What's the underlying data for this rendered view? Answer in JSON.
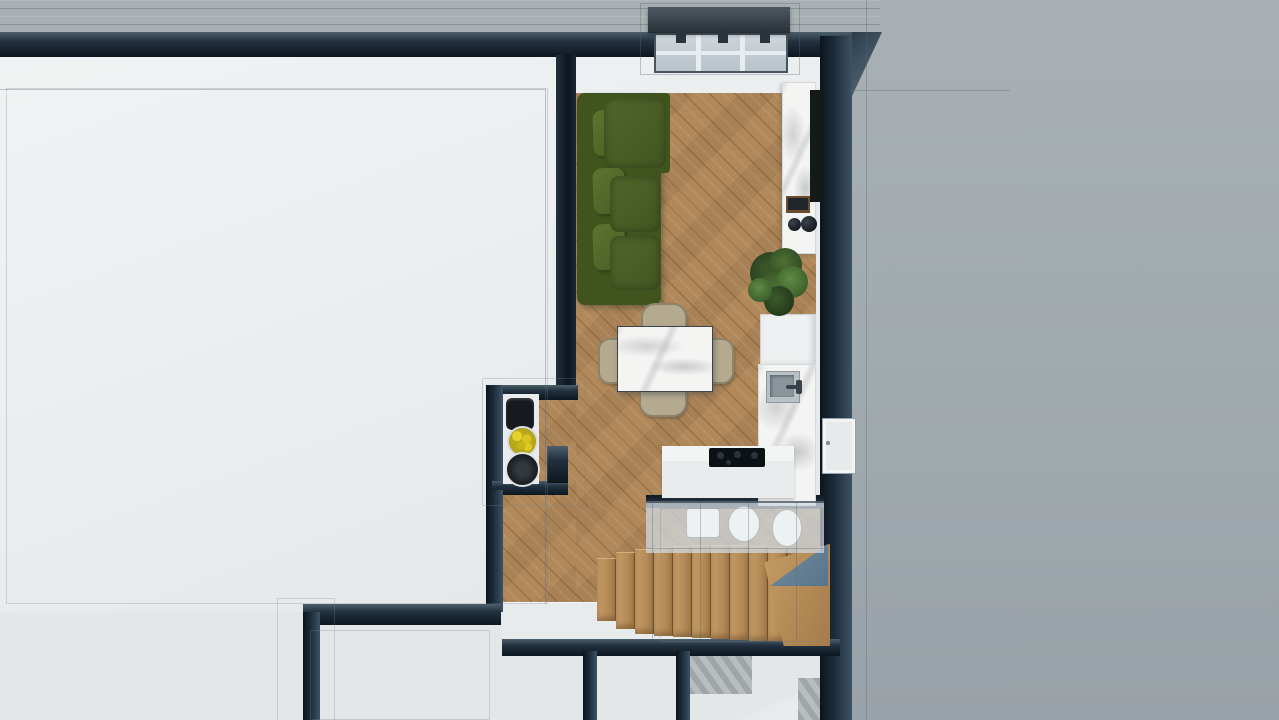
{
  "scene": {
    "title": "Top-down 3D architectural render of an apartment floor",
    "view": "cutaway dollhouse top view",
    "rooms": [
      {
        "label": "flat-roof-terrace"
      },
      {
        "label": "living-room"
      },
      {
        "label": "dining-area"
      },
      {
        "label": "kitchen"
      },
      {
        "label": "hallway-niche"
      },
      {
        "label": "staircase"
      },
      {
        "label": "bathroom-below"
      },
      {
        "label": "lower-rooms"
      }
    ],
    "furniture": [
      "green-corner-sofa",
      "marble-dining-table",
      "four-dining-chairs",
      "marble-tv-console",
      "tv-panel",
      "potted-plant",
      "kitchen-sink",
      "induction-cooktop",
      "kitchen-island",
      "tall-cabinet",
      "coffee-machine",
      "lemon-bowl",
      "dark-plate",
      "wood-stairs",
      "roof-window",
      "entry-door"
    ]
  },
  "palette": {
    "bg_right_top": "#a8b0b4",
    "bg_right": "#a0a9ae",
    "bg_right_bot": "#99a2a8",
    "interior": "#eaedee",
    "interior_dim": "#e3e7e8",
    "wall_dark": "#16222e",
    "wood": "#b1885a",
    "sofa_base": "#42541e",
    "chair": "#b4aa90",
    "cooktop": "#0c1115",
    "railing_blue": "#67829a",
    "lemon_yellow": "#d4c21c",
    "plant_green": "#41632c"
  },
  "generated": {
    "sofa_cushions": {
      "class": "sofa-cushion",
      "name": "sofa-cushion",
      "items": [
        {
          "x": 593,
          "y": 110,
          "w": 32,
          "h": 46,
          "kind": "back"
        },
        {
          "x": 593,
          "y": 168,
          "w": 32,
          "h": 46,
          "kind": "back"
        },
        {
          "x": 593,
          "y": 224,
          "w": 32,
          "h": 46,
          "kind": "back"
        },
        {
          "x": 604,
          "y": 98,
          "w": 62,
          "h": 70,
          "kind": "seat"
        },
        {
          "x": 610,
          "y": 176,
          "w": 50,
          "h": 56,
          "kind": "seat"
        },
        {
          "x": 610,
          "y": 236,
          "w": 50,
          "h": 54,
          "kind": "seat"
        }
      ]
    },
    "stair_treads": {
      "class": "tread",
      "name": "stair-tread",
      "items": [
        {
          "x": 597,
          "y": 558,
          "w": 18,
          "h": 62
        },
        {
          "x": 616,
          "y": 552,
          "w": 18,
          "h": 76
        },
        {
          "x": 635,
          "y": 549,
          "w": 18,
          "h": 84
        },
        {
          "x": 654,
          "y": 547,
          "w": 18,
          "h": 88
        },
        {
          "x": 673,
          "y": 546,
          "w": 18,
          "h": 90
        },
        {
          "x": 692,
          "y": 545,
          "w": 18,
          "h": 92
        },
        {
          "x": 711,
          "y": 545,
          "w": 18,
          "h": 93
        },
        {
          "x": 730,
          "y": 545,
          "w": 18,
          "h": 94
        },
        {
          "x": 749,
          "y": 546,
          "w": 18,
          "h": 94
        },
        {
          "x": 768,
          "y": 547,
          "w": 18,
          "h": 93
        }
      ]
    },
    "dining_chairs": {
      "class": "chair",
      "name": "dining-chair",
      "items": [
        {
          "x": 641,
          "y": 303,
          "w": 42,
          "h": 26,
          "r": "14px 14px 8px 8px"
        },
        {
          "x": 598,
          "y": 338,
          "w": 24,
          "h": 42,
          "r": "12px 8px 8px 12px"
        },
        {
          "x": 706,
          "y": 338,
          "w": 24,
          "h": 42,
          "r": "8px 12px 12px 8px"
        },
        {
          "x": 639,
          "y": 385,
          "w": 44,
          "h": 28,
          "r": "8px 8px 14px 14px"
        }
      ]
    },
    "bath_fixtures": {
      "class": "bath-fixture",
      "name": "bath-fixture",
      "items": [
        {
          "x": 686,
          "y": 508,
          "w": 32,
          "h": 28,
          "kind": "rect"
        },
        {
          "x": 728,
          "y": 506,
          "w": 30,
          "h": 34,
          "kind": "oval"
        },
        {
          "x": 772,
          "y": 509,
          "w": 28,
          "h": 36,
          "kind": "oval"
        }
      ]
    },
    "plant_leaves": {
      "class": "leaf",
      "name": "plant-leaf",
      "items": [
        {
          "x": 750,
          "y": 252,
          "d": 42,
          "kind": "dark"
        },
        {
          "x": 768,
          "y": 248,
          "d": 34,
          "kind": "mid"
        },
        {
          "x": 758,
          "y": 270,
          "d": 38,
          "kind": "mid"
        },
        {
          "x": 776,
          "y": 266,
          "d": 32,
          "kind": "light"
        },
        {
          "x": 764,
          "y": 286,
          "d": 30,
          "kind": "dark"
        },
        {
          "x": 748,
          "y": 278,
          "d": 24,
          "kind": "light"
        }
      ]
    },
    "cooktop_burners": {
      "class": "burner",
      "name": "cooktop-burner",
      "items": [
        {
          "x": 717,
          "y": 452,
          "d": 7
        },
        {
          "x": 734,
          "y": 451,
          "d": 7
        },
        {
          "x": 751,
          "y": 452,
          "d": 7
        },
        {
          "x": 726,
          "y": 460,
          "d": 5
        }
      ]
    },
    "decor_circles": {
      "class": "decor",
      "name": "decor-item",
      "items": [
        {
          "x": 788,
          "y": 218,
          "d": 13,
          "kind": "vase"
        },
        {
          "x": 801,
          "y": 216,
          "d": 16,
          "kind": "vase"
        },
        {
          "x": 507,
          "y": 426,
          "d": 27,
          "kind": "lemons"
        },
        {
          "x": 505,
          "y": 452,
          "d": 31,
          "kind": "plate"
        }
      ]
    },
    "wireframe_lines": {
      "class": "wire",
      "name": "model-edge",
      "items": [
        {
          "x": 6,
          "y": 88,
          "w": 540,
          "h": 514,
          "kind": "box faint"
        },
        {
          "x": 545,
          "y": 90,
          "w": 1,
          "h": 514,
          "kind": "line"
        },
        {
          "x": 0,
          "y": 89,
          "w": 546,
          "h": 1,
          "kind": "line"
        },
        {
          "x": 640,
          "y": 3,
          "w": 158,
          "h": 70,
          "kind": "box"
        },
        {
          "x": 482,
          "y": 378,
          "w": 102,
          "h": 126,
          "kind": "box faint"
        },
        {
          "x": 277,
          "y": 598,
          "w": 56,
          "h": 122,
          "kind": "box faint"
        },
        {
          "x": 310,
          "y": 630,
          "w": 178,
          "h": 88,
          "kind": "box faint"
        },
        {
          "x": 866,
          "y": 0,
          "w": 1,
          "h": 720,
          "kind": "line"
        },
        {
          "x": 850,
          "y": 90,
          "w": 160,
          "h": 1,
          "kind": "line"
        },
        {
          "x": 652,
          "y": 503,
          "w": 1,
          "h": 138,
          "kind": "line"
        },
        {
          "x": 700,
          "y": 503,
          "w": 1,
          "h": 138,
          "kind": "line"
        },
        {
          "x": 748,
          "y": 503,
          "w": 1,
          "h": 138,
          "kind": "line"
        },
        {
          "x": 796,
          "y": 503,
          "w": 1,
          "h": 138,
          "kind": "line"
        },
        {
          "x": 646,
          "y": 548,
          "w": 178,
          "h": 1,
          "kind": "line"
        },
        {
          "x": 660,
          "y": 508,
          "w": 160,
          "h": 132,
          "kind": "box faint"
        }
      ]
    }
  }
}
